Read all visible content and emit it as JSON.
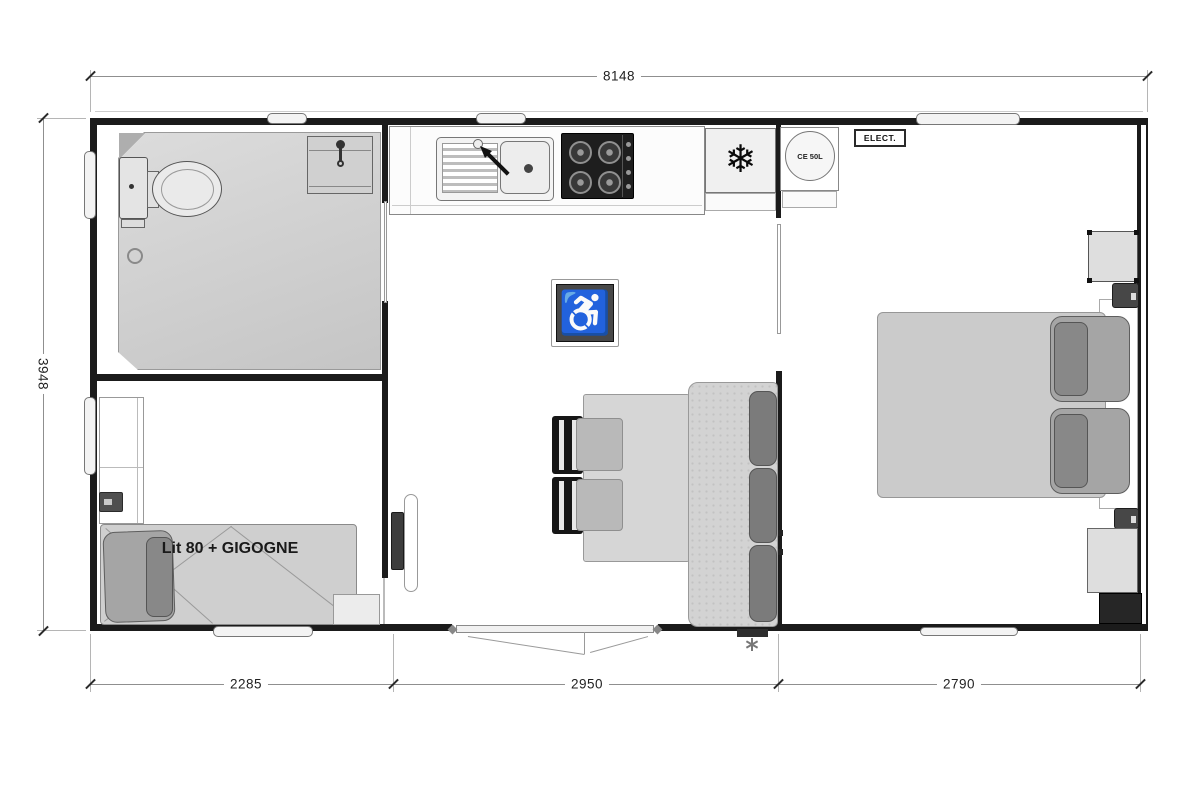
{
  "dimensions": {
    "top": "8148",
    "left": "3948",
    "bottom": [
      "2285",
      "2950",
      "2790"
    ]
  },
  "labels": {
    "bed": "Lit 80 + GIGOGNE",
    "water_heater": "CE 50L",
    "electric_panel": "ELECT."
  },
  "icons": {
    "freezer": "❄",
    "accessible": "♿"
  },
  "colors": {
    "wall": "#1b1b1b",
    "furniture_light": "#cfcfcf",
    "cushion_dark": "#7b7b7b",
    "accessible_sign_bg": "#484848",
    "stove": "#1e1e1e"
  }
}
